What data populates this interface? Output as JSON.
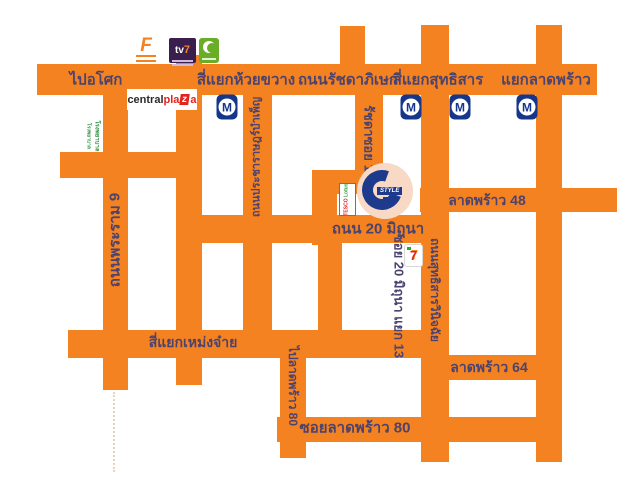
{
  "map": {
    "colors": {
      "road": "#F58220",
      "label_text": "#4b436f",
      "mrt_blue": "#16368c",
      "cstyle_navy": "#1d3a8c",
      "cstyle_circle_bg": "#f7d9c6"
    },
    "road_labels": {
      "pai_asok": "ไปอโศก",
      "si_yaek_huai_khwang": "สี่แยกห้วยขวาง",
      "thanon_ratchadaphisek": "ถนนรัชดาภิเษก",
      "si_yaek_sutthisan": "สี่แยกสุทธิสาร",
      "yaek_lat_phrao": "แยกลาดพร้าว",
      "thanon_phra_ram_9": "ถนนพระราม 9",
      "thanon_pracharat_bamphen": "ถนนประชาราษฎร์บำเพ็ญ",
      "ratchada_soi_18": "รัชดาซอย 18",
      "thanon_20_mithuna": "ถนน 20 มิถุนา",
      "soi_20_mithuna_yaek_13": "ซอย 20 มิถุนา แยก 13",
      "thanon_sutthisan_winitchai": "ถนนสุทธิสารวินิจฉัย",
      "lat_phrao_48": "ลาดพร้าว 48",
      "si_yaek_meng_jai": "สี่แยกเหม่งจ๋าย",
      "pai_lat_phrao_80": "ไปลาดพร้าว 80",
      "lat_phrao_64": "ลาดพร้าว 64",
      "soi_lat_phrao_80": "ซอยลาดพร้าว 80"
    },
    "mrt": {
      "label": "M"
    },
    "logos": {
      "f_text": "F",
      "tv7_tv": "tv",
      "tv7_seven": "7",
      "central_1": "central",
      "central_2": "pla",
      "central_3": "z",
      "central_4": "a",
      "hospital_line1": "โรงพยาบาล",
      "hospital_line2": "โรงพยาบาล",
      "tesco_1": "TESCO",
      "tesco_2": "Lotus",
      "seven_eleven": "7",
      "cstyle_text": "STYLE"
    }
  }
}
